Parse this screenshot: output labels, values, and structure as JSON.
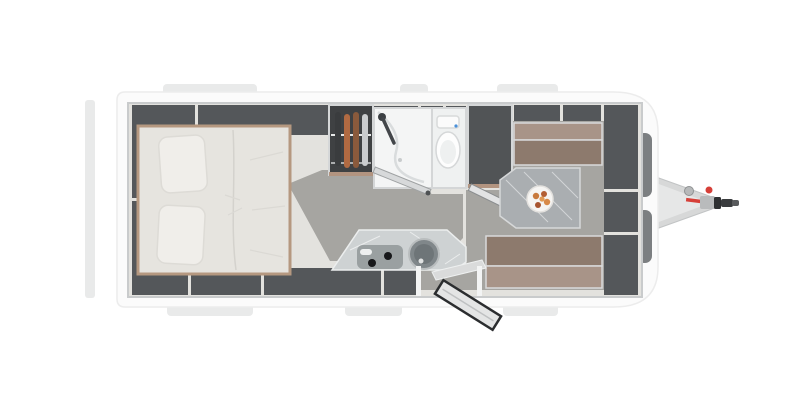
{
  "title": "Caravan floor plan - top view render",
  "brand": {
    "label": "WEINSBERG"
  },
  "colors": {
    "body": "#fbfbfb",
    "locker": "#54575a",
    "floor_walkway": "#a6a5a1",
    "floor_base": "#e3e2de",
    "wood_trim": "#b59880",
    "cushion_seat": "#8d7a6d",
    "cushion_back": "#a89488",
    "mattress": "#e6e4df",
    "marble": "#ced2d3",
    "window": "#7c7f81",
    "accent_red": "#d63f38"
  },
  "icons": {
    "bed": "double-bed-with-two-pillows",
    "wardrobe": "clothes-hangers-on-rail",
    "shower": "shower-tray-with-handheld-head",
    "toilet": "toilet-bowl",
    "kitchen": "sink-and-two-burner-hob",
    "dinette": "face-to-face-lounge-with-table",
    "plate": "plate-of-food",
    "entry_door": "open-entrance-door",
    "hitch": "a-frame-drawbar-with-coupling",
    "front_window": "front-panoramic-window"
  }
}
